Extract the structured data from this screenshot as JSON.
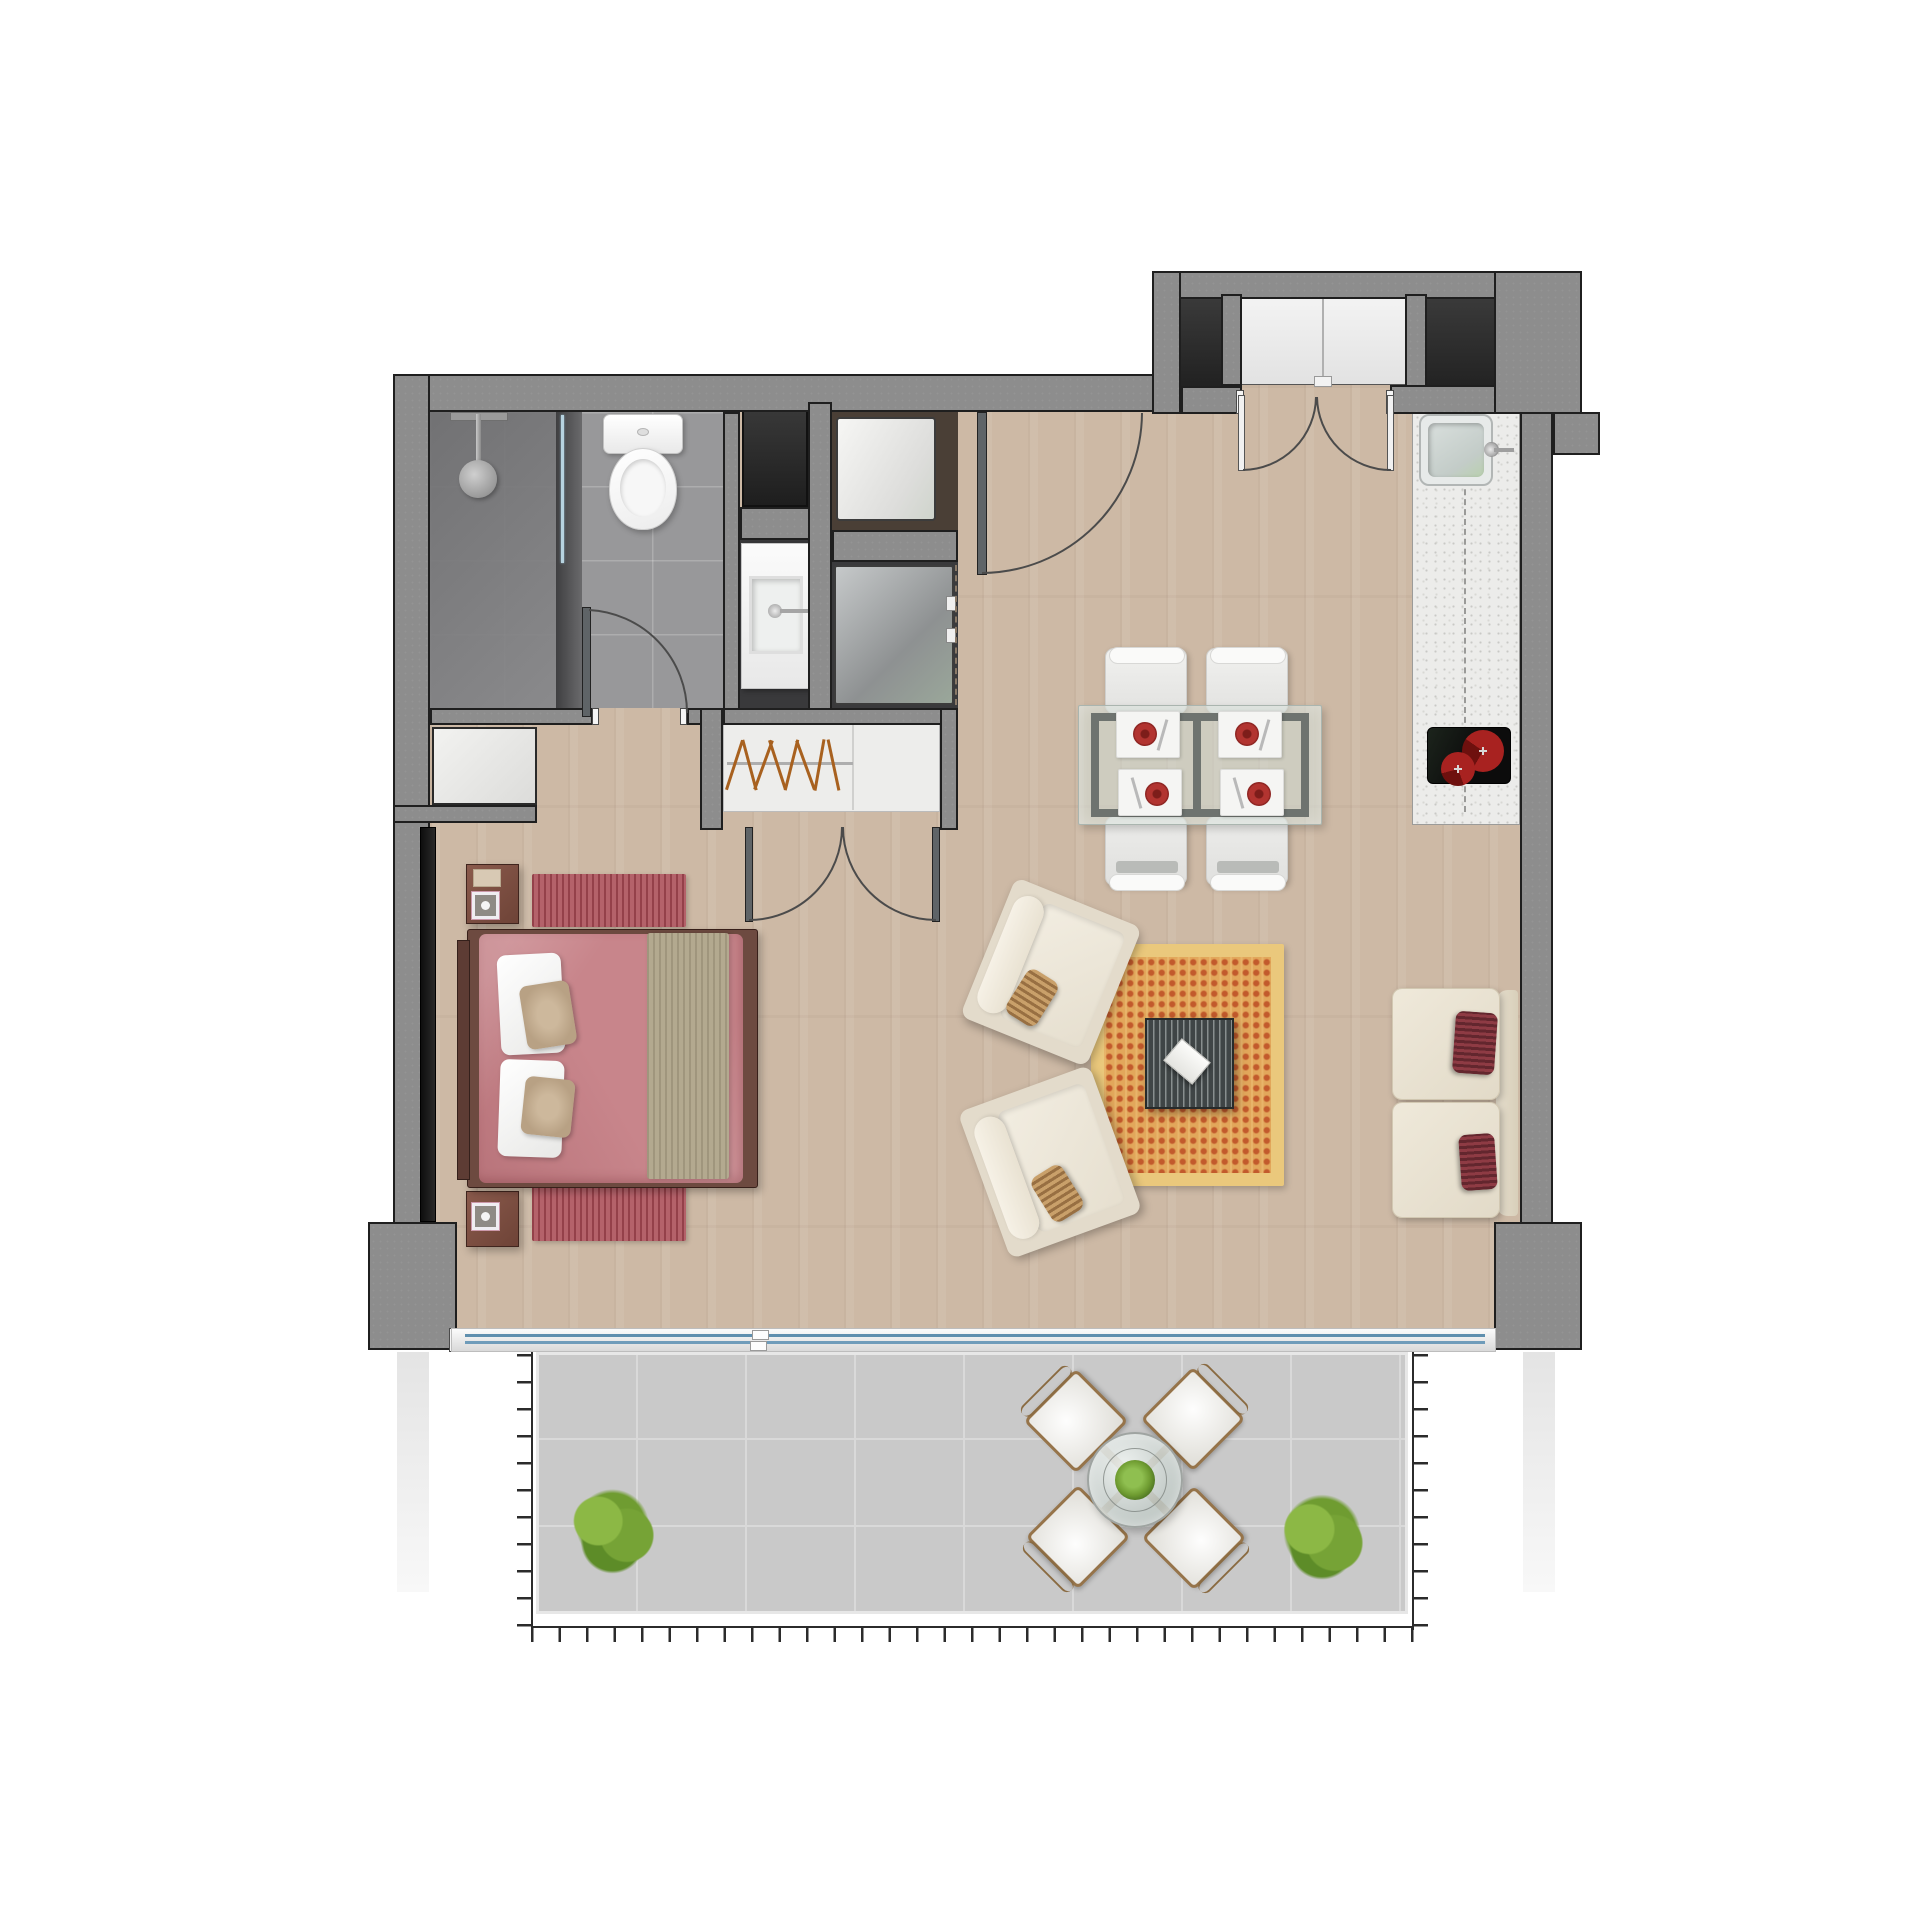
{
  "meta": {
    "title": "Apartment floor plan — top-down 3D render",
    "canvas": {
      "width_px": 1920,
      "height_px": 1920
    },
    "style": "photorealistic rendered plan, no text labels"
  },
  "palette": {
    "wall_gray": "#8d8d8d",
    "wall_outline": "#1f1f1f",
    "shaft_dark": "#2c2c2c",
    "wood_floor": "#cdb9a5",
    "bath_tile": "#98989a",
    "terrace_tile": "#c9c9c9",
    "counter_white": "#ececea",
    "bed_duvet_rose": "#c8858b",
    "accent_red_rug": "#b4626a",
    "living_rug_orange": "#e2a75b",
    "living_rug_border": "#eac87c",
    "cream_upholstery": "#ebe4d5",
    "pillow_wine": "#8e3b44",
    "cooktop_red": "#a82220",
    "plant_green": "#6f9c31",
    "glass_blue": "#6d9cbe"
  },
  "plan": {
    "regions": {
      "bathroom": "Bathroom with shower, toilet and glass partition",
      "vanity": "Vanity basin niche",
      "laundry": "Laundry niche with washer and water heater",
      "storage": "Dark storage closet",
      "wardrobe": "Wardrobe closet with hanger rod",
      "bedroom": "Bedroom",
      "living": "Living room",
      "dining": "Dining area",
      "kitchen": "Kitchen counter run",
      "entry": "Entry hall",
      "lobby": "Elevator lobby with double entry doors",
      "terrace": "Tiled terrace with railing"
    },
    "fixtures": [
      "shower head and glass screen",
      "toilet",
      "vanity basin with faucet",
      "washing machine with dashed enclosure",
      "water heater appliance",
      "kitchen sink with faucet",
      "two-burner cooktop"
    ],
    "furniture": [
      "double bed with rose duvet, two white pillows, two tan pillows, beige runner",
      "two nightstands with square lamps",
      "two striped red bedside rugs",
      "two cream armchairs with tan bolster pillows",
      "orange checkered area rug",
      "dark slatted coffee table with white book",
      "two-seat cream sofa with two wine striped pillows",
      "glass dining table with metal frame",
      "four white dining chairs",
      "four placemats with red plates and cutlery"
    ],
    "outdoor": [
      "round glass table with planter centerpiece",
      "four wicker chairs with white cushions placed diagonally",
      "two green shrubs",
      "perimeter railing drawn with tick marks",
      "sliding glass door track with blue glazing lines"
    ],
    "doors": {
      "entry_double": "double entry doors swinging in from lobby",
      "bathroom": "single door swinging into bathroom",
      "hall_pivot": "open service-hall door leaf with quarter swing arc",
      "wardrobe_double": "double wardrobe doors swinging into bedroom"
    },
    "counts": {
      "dining_chairs": 4,
      "outdoor_chairs": 4,
      "burners": 2,
      "shrubs": 2,
      "armchairs": 2,
      "sofa_pillows": 2
    }
  }
}
